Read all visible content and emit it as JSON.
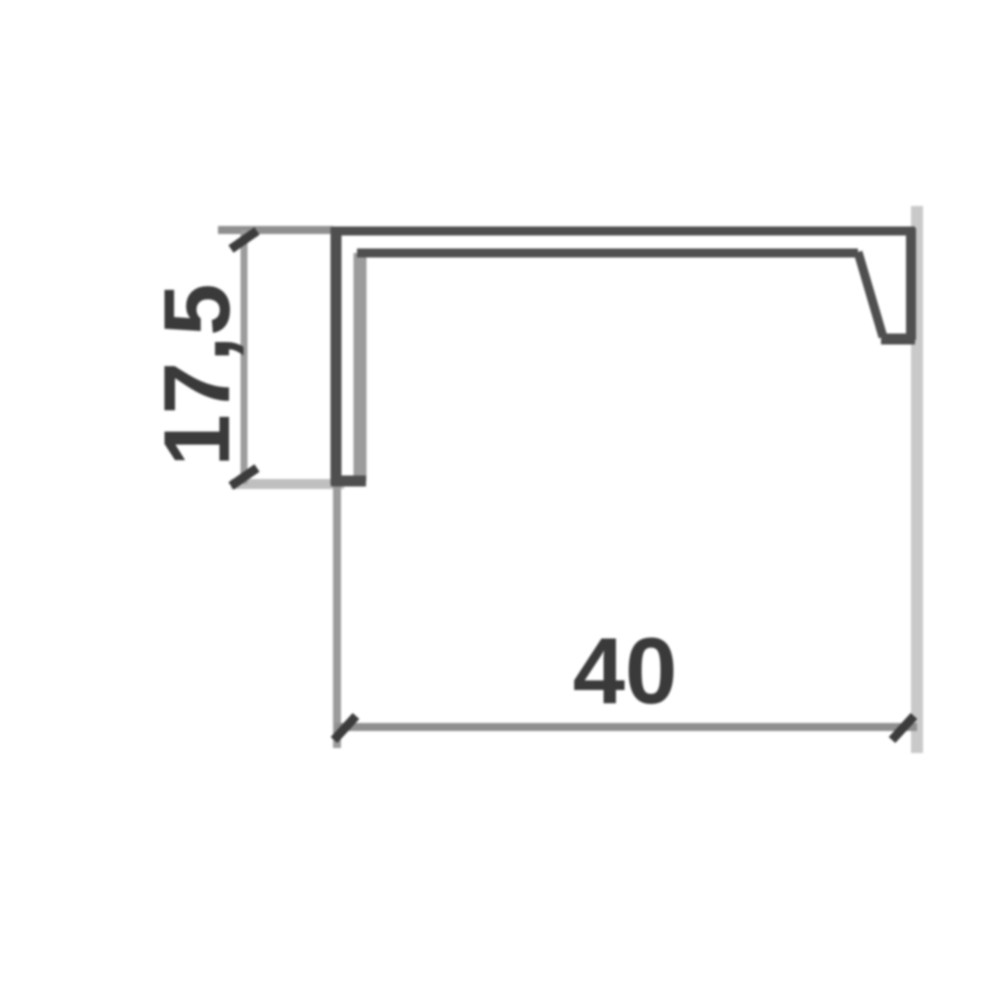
{
  "drawing": {
    "kind": "profile-cross-section",
    "height_dimension": {
      "label": "17,5",
      "orientation": "vertical"
    },
    "width_dimension": {
      "label": "40",
      "orientation": "horizontal"
    }
  },
  "colors": {
    "background": "#ffffff",
    "profile_dark": "#4f4f4f",
    "profile_inner": "#9c9c9c",
    "dim_line": "#8f8f8f",
    "ext_medium": "#9c9c9c",
    "ext_light": "#bfbfbf",
    "ext_lighter": "#c9c9c9",
    "tick": "#3c3c3c",
    "label": "#3a3a3a"
  }
}
